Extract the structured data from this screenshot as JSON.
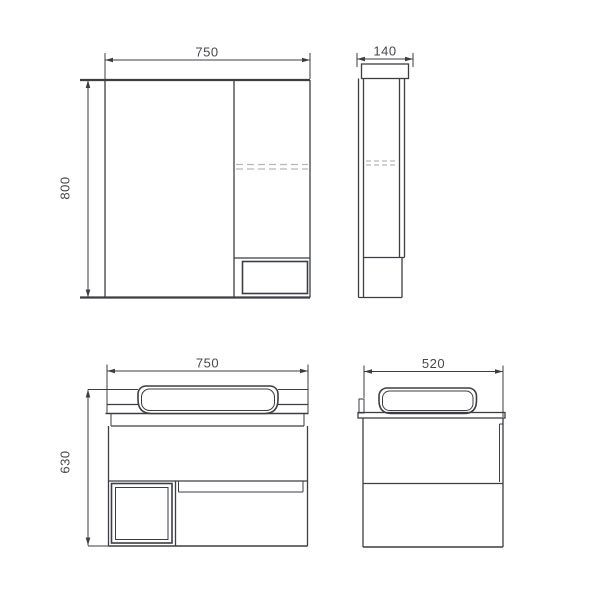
{
  "drawing": {
    "views": {
      "mirror_front": {
        "width_label": "750",
        "height_label": "800"
      },
      "mirror_side": {
        "depth_label": "140"
      },
      "vanity_front": {
        "width_label": "750",
        "height_label": "630"
      },
      "vanity_side": {
        "depth_label": "520"
      }
    },
    "colors": {
      "line": "#3c3e44",
      "dashed": "#b6b6b6",
      "text": "#46484e",
      "background": "#ffffff"
    }
  }
}
